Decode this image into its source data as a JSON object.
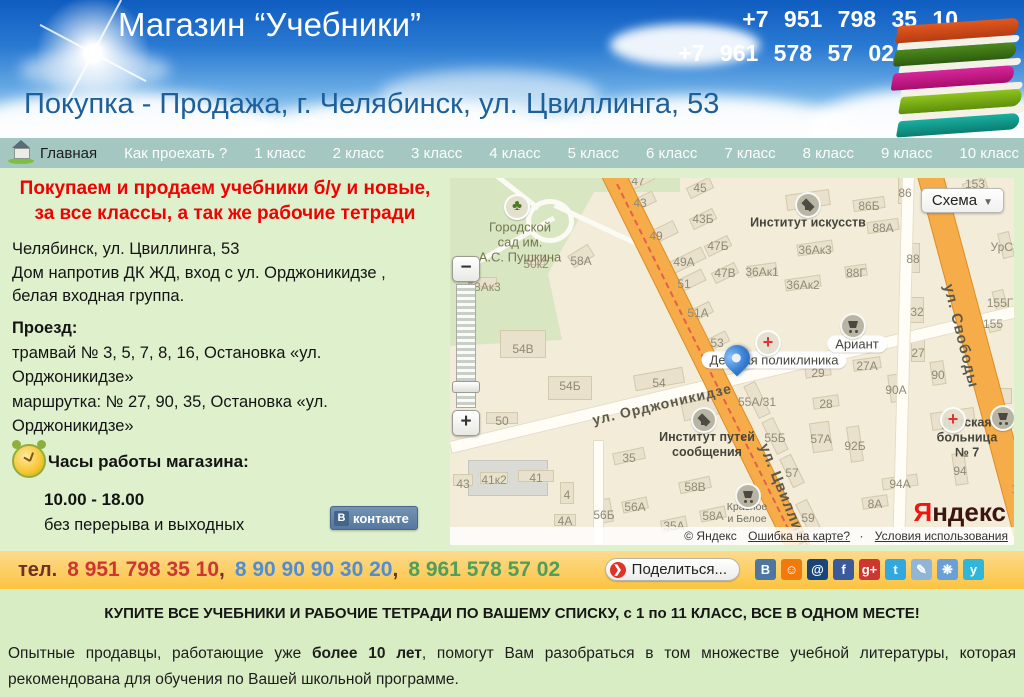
{
  "header": {
    "title": "Магазин “Учебники”",
    "phones": [
      "+7 951 798 35 10",
      "+7 961 578 57 02"
    ],
    "subtitle": "Покупка - Продажа, г. Челябинск, ул. Цвиллинга, 53"
  },
  "nav": {
    "home": "Главная",
    "items": [
      "Как проехать ?",
      "1 класс",
      "2 класс",
      "3 класс",
      "4 класс",
      "5 класс",
      "6 класс",
      "7 класс",
      "8 класс",
      "9 класс",
      "10 класс",
      "11 класс"
    ]
  },
  "panel": {
    "promo": "Покупаем и продаем учебники б/у и новые,\nза все классы,  а так же рабочие тетради",
    "address": [
      "Челябинск, ул. Цвиллинга, 53",
      "Дом напротив ДК ЖД, вход с ул. Орджоникидзе ,",
      "белая входная группа."
    ],
    "transit_title": "Проезд:",
    "transit": [
      "трамвай № 3, 5, 7, 8, 16, Остановка «ул. Орджоникидзе»",
      "маршрутка: № 27, 90, 35, Остановка «ул. Орджоникидзе»"
    ],
    "hours_title": "Часы работы магазина:",
    "hours": "10.00 - 18.00",
    "hours_note": "без перерыва и выходных",
    "vk_icon_letter": "В",
    "vk_label": "контакте"
  },
  "map": {
    "mode_button": "Схема",
    "zoom_in": "+",
    "zoom_out": "−",
    "logo_first": "Я",
    "logo_rest": "ндекс",
    "attribution": "© Яндекс",
    "error_link": "Ошибка на карте?",
    "terms_link": "Условия использования",
    "pin": {
      "x": 287,
      "y": 202
    },
    "streets": [
      {
        "text": "ул. Орджоникидзе",
        "x": 212,
        "y": 226,
        "rot": -13,
        "size": 14
      },
      {
        "text": "ул. Цвиллинга",
        "x": 336,
        "y": 322,
        "rot": 68,
        "size": 15
      },
      {
        "text": "ул. Свободы",
        "x": 511,
        "y": 158,
        "rot": 76,
        "size": 15
      }
    ],
    "places": [
      {
        "text": "Городской\nсад им.\nА.С. Пушкина",
        "x": 70,
        "y": 64,
        "cls": "park-label"
      },
      {
        "text": "Институт искусств",
        "x": 358,
        "y": 45,
        "cls": ""
      },
      {
        "text": "Институт путей\nсообщения",
        "x": 257,
        "y": 267,
        "cls": ""
      },
      {
        "text": "Детская поликлиника",
        "x": 324,
        "y": 182,
        "cls": "plate"
      },
      {
        "text": "Ариант",
        "x": 407,
        "y": 166,
        "cls": "plate"
      },
      {
        "text": "Детская больница № 7",
        "x": 517,
        "y": 260,
        "cls": ""
      },
      {
        "text": "Красное\nи Белое",
        "x": 297,
        "y": 335,
        "cls": "small-label"
      }
    ],
    "numbers": [
      {
        "t": "47",
        "x": 188,
        "y": 3
      },
      {
        "t": "45",
        "x": 250,
        "y": 10
      },
      {
        "t": "43",
        "x": 190,
        "y": 25
      },
      {
        "t": "43Б",
        "x": 253,
        "y": 41
      },
      {
        "t": "49",
        "x": 206,
        "y": 58
      },
      {
        "t": "47Б",
        "x": 268,
        "y": 68
      },
      {
        "t": "49А",
        "x": 234,
        "y": 84
      },
      {
        "t": "47В",
        "x": 275,
        "y": 95
      },
      {
        "t": "51",
        "x": 234,
        "y": 106
      },
      {
        "t": "50к2",
        "x": 86,
        "y": 86
      },
      {
        "t": "58А",
        "x": 131,
        "y": 83
      },
      {
        "t": "58Ак3",
        "x": 34,
        "y": 109
      },
      {
        "t": "51А",
        "x": 248,
        "y": 135
      },
      {
        "t": "54В",
        "x": 73,
        "y": 171
      },
      {
        "t": "53",
        "x": 267,
        "y": 165
      },
      {
        "t": "86",
        "x": 455,
        "y": 15
      },
      {
        "t": "86Б",
        "x": 419,
        "y": 28
      },
      {
        "t": "88А",
        "x": 433,
        "y": 50
      },
      {
        "t": "36Ак3",
        "x": 365,
        "y": 72
      },
      {
        "t": "36Ак1",
        "x": 312,
        "y": 94
      },
      {
        "t": "36Ак2",
        "x": 353,
        "y": 107
      },
      {
        "t": "88Г",
        "x": 406,
        "y": 95
      },
      {
        "t": "88",
        "x": 463,
        "y": 81
      },
      {
        "t": "УрСЭ",
        "x": 556,
        "y": 69
      },
      {
        "t": "153",
        "x": 525,
        "y": 6
      },
      {
        "t": "155Г",
        "x": 550,
        "y": 125
      },
      {
        "t": "155",
        "x": 543,
        "y": 146
      },
      {
        "t": "32",
        "x": 467,
        "y": 134
      },
      {
        "t": "27",
        "x": 468,
        "y": 175
      },
      {
        "t": "54Б",
        "x": 120,
        "y": 208
      },
      {
        "t": "54",
        "x": 209,
        "y": 205
      },
      {
        "t": "50",
        "x": 52,
        "y": 243
      },
      {
        "t": "43",
        "x": 13,
        "y": 306
      },
      {
        "t": "41к2",
        "x": 44,
        "y": 302
      },
      {
        "t": "41",
        "x": 86,
        "y": 300
      },
      {
        "t": "4",
        "x": 117,
        "y": 317
      },
      {
        "t": "4А",
        "x": 115,
        "y": 343
      },
      {
        "t": "56Б",
        "x": 154,
        "y": 337
      },
      {
        "t": "56А",
        "x": 185,
        "y": 329
      },
      {
        "t": "35",
        "x": 179,
        "y": 280
      },
      {
        "t": "35А",
        "x": 224,
        "y": 348
      },
      {
        "t": "58В",
        "x": 245,
        "y": 309
      },
      {
        "t": "58А",
        "x": 263,
        "y": 338
      },
      {
        "t": "27А",
        "x": 417,
        "y": 188
      },
      {
        "t": "29",
        "x": 368,
        "y": 195
      },
      {
        "t": "90",
        "x": 488,
        "y": 197
      },
      {
        "t": "90А",
        "x": 446,
        "y": 212
      },
      {
        "t": "28",
        "x": 376,
        "y": 226
      },
      {
        "t": "55А/31",
        "x": 307,
        "y": 224
      },
      {
        "t": "55Б",
        "x": 325,
        "y": 260
      },
      {
        "t": "57А",
        "x": 371,
        "y": 261
      },
      {
        "t": "92Б",
        "x": 405,
        "y": 268
      },
      {
        "t": "94",
        "x": 510,
        "y": 293
      },
      {
        "t": "94А",
        "x": 450,
        "y": 306
      },
      {
        "t": "8А",
        "x": 425,
        "y": 326
      },
      {
        "t": "57",
        "x": 342,
        "y": 295
      },
      {
        "t": "59",
        "x": 358,
        "y": 340
      },
      {
        "t": "15",
        "x": 568,
        "y": 311
      }
    ],
    "pois": [
      {
        "type": "tree",
        "x": 67,
        "y": 29
      },
      {
        "type": "cap",
        "x": 358,
        "y": 27
      },
      {
        "type": "cap",
        "x": 254,
        "y": 242
      },
      {
        "type": "cross",
        "x": 318,
        "y": 165
      },
      {
        "type": "cross",
        "x": 503,
        "y": 242
      },
      {
        "type": "cart",
        "x": 403,
        "y": 148
      },
      {
        "type": "cart",
        "x": 553,
        "y": 240
      },
      {
        "type": "cart",
        "x": 298,
        "y": 318
      }
    ],
    "buildings": [
      [
        188,
        3,
        32,
        12,
        -26
      ],
      [
        250,
        10,
        26,
        12,
        -26
      ],
      [
        190,
        25,
        32,
        12,
        -26
      ],
      [
        253,
        41,
        26,
        12,
        -26
      ],
      [
        206,
        58,
        44,
        14,
        -26
      ],
      [
        268,
        68,
        26,
        12,
        -26
      ],
      [
        234,
        84,
        44,
        13,
        -26
      ],
      [
        275,
        95,
        26,
        12,
        -26
      ],
      [
        234,
        106,
        44,
        13,
        -26
      ],
      [
        248,
        135,
        30,
        12,
        -26
      ],
      [
        267,
        163,
        24,
        12,
        -26
      ],
      [
        86,
        82,
        18,
        10,
        0
      ],
      [
        131,
        78,
        24,
        14,
        -32
      ],
      [
        34,
        104,
        26,
        10,
        0
      ],
      [
        73,
        166,
        46,
        28,
        0
      ],
      [
        120,
        210,
        44,
        24,
        0
      ],
      [
        209,
        201,
        50,
        16,
        -10
      ],
      [
        52,
        240,
        32,
        12,
        0
      ],
      [
        13,
        302,
        20,
        12,
        0
      ],
      [
        44,
        300,
        28,
        12,
        0
      ],
      [
        86,
        298,
        36,
        12,
        0
      ],
      [
        117,
        315,
        14,
        22,
        0
      ],
      [
        115,
        342,
        22,
        12,
        0
      ],
      [
        154,
        333,
        16,
        24,
        -10
      ],
      [
        185,
        327,
        26,
        12,
        -12
      ],
      [
        179,
        278,
        32,
        12,
        -12
      ],
      [
        224,
        346,
        26,
        12,
        -12
      ],
      [
        245,
        307,
        32,
        12,
        -12
      ],
      [
        263,
        336,
        26,
        12,
        -12
      ],
      [
        254,
        230,
        44,
        18,
        -12
      ],
      [
        358,
        22,
        44,
        16,
        -8
      ],
      [
        419,
        26,
        32,
        12,
        -8
      ],
      [
        433,
        48,
        32,
        12,
        -8
      ],
      [
        365,
        70,
        36,
        12,
        -8
      ],
      [
        312,
        92,
        30,
        12,
        -8
      ],
      [
        353,
        105,
        36,
        12,
        -8
      ],
      [
        406,
        93,
        22,
        12,
        -8
      ],
      [
        455,
        12,
        14,
        28,
        0
      ],
      [
        463,
        80,
        14,
        30,
        0
      ],
      [
        525,
        8,
        24,
        12,
        -18
      ],
      [
        556,
        67,
        26,
        12,
        76
      ],
      [
        550,
        123,
        22,
        12,
        76
      ],
      [
        543,
        144,
        20,
        12,
        76
      ],
      [
        467,
        132,
        14,
        26,
        0
      ],
      [
        468,
        173,
        14,
        22,
        0
      ],
      [
        553,
        218,
        18,
        16,
        0
      ],
      [
        417,
        186,
        28,
        12,
        -8
      ],
      [
        368,
        193,
        26,
        12,
        -8
      ],
      [
        488,
        195,
        14,
        24,
        -8
      ],
      [
        446,
        210,
        14,
        28,
        -8
      ],
      [
        376,
        224,
        26,
        12,
        -8
      ],
      [
        307,
        222,
        36,
        13,
        64
      ],
      [
        325,
        258,
        36,
        13,
        64
      ],
      [
        371,
        259,
        20,
        30,
        -8
      ],
      [
        405,
        266,
        13,
        36,
        -8
      ],
      [
        342,
        293,
        32,
        13,
        64
      ],
      [
        358,
        338,
        32,
        13,
        64
      ],
      [
        510,
        291,
        13,
        32,
        -8
      ],
      [
        450,
        304,
        36,
        12,
        -8
      ],
      [
        425,
        324,
        26,
        12,
        -8
      ],
      [
        503,
        241,
        44,
        18,
        -8
      ]
    ]
  },
  "contact_bar": {
    "label": "тел.",
    "phones": [
      {
        "number": "8 951 798 35 10",
        "color": "#cd3632"
      },
      {
        "number": "8 90 90 90 30 20",
        "color": "#4e8ed8"
      },
      {
        "number": "8 961 578 57 02",
        "color": "#4f9e5a"
      }
    ],
    "share_button": "Поделиться...",
    "social": [
      {
        "name": "vk",
        "glyph": "В",
        "color": "#4d76a1"
      },
      {
        "name": "odnoklassniki",
        "glyph": "☺",
        "color": "#f2790b"
      },
      {
        "name": "mail-ru",
        "glyph": "@",
        "color": "#18457c"
      },
      {
        "name": "facebook",
        "glyph": "f",
        "color": "#3b5a9b"
      },
      {
        "name": "google-plus",
        "glyph": "g+",
        "color": "#cc3732"
      },
      {
        "name": "twitter",
        "glyph": "t",
        "color": "#32a8e0"
      },
      {
        "name": "livejournal",
        "glyph": "✎",
        "color": "#8fb6d8"
      },
      {
        "name": "liveinternet",
        "glyph": "❋",
        "color": "#6aa0d8"
      },
      {
        "name": "bird",
        "glyph": "y",
        "color": "#2fb6d8"
      }
    ]
  },
  "footer": {
    "headline": "КУПИТЕ ВСЕ УЧЕБНИКИ И РАБОЧИЕ ТЕТРАДИ ПО ВАШЕМУ СПИСКУ, с 1 по 11 КЛАСС, ВСЕ В ОДНОМ МЕСТЕ!",
    "body_prefix": "Опытные продавцы, работающие уже ",
    "body_bold": "более 10 лет",
    "body_suffix": ", помогут Вам разобраться в том множестве учебной литературы, которая рекомендована для обучения по Вашей школьной программе."
  }
}
